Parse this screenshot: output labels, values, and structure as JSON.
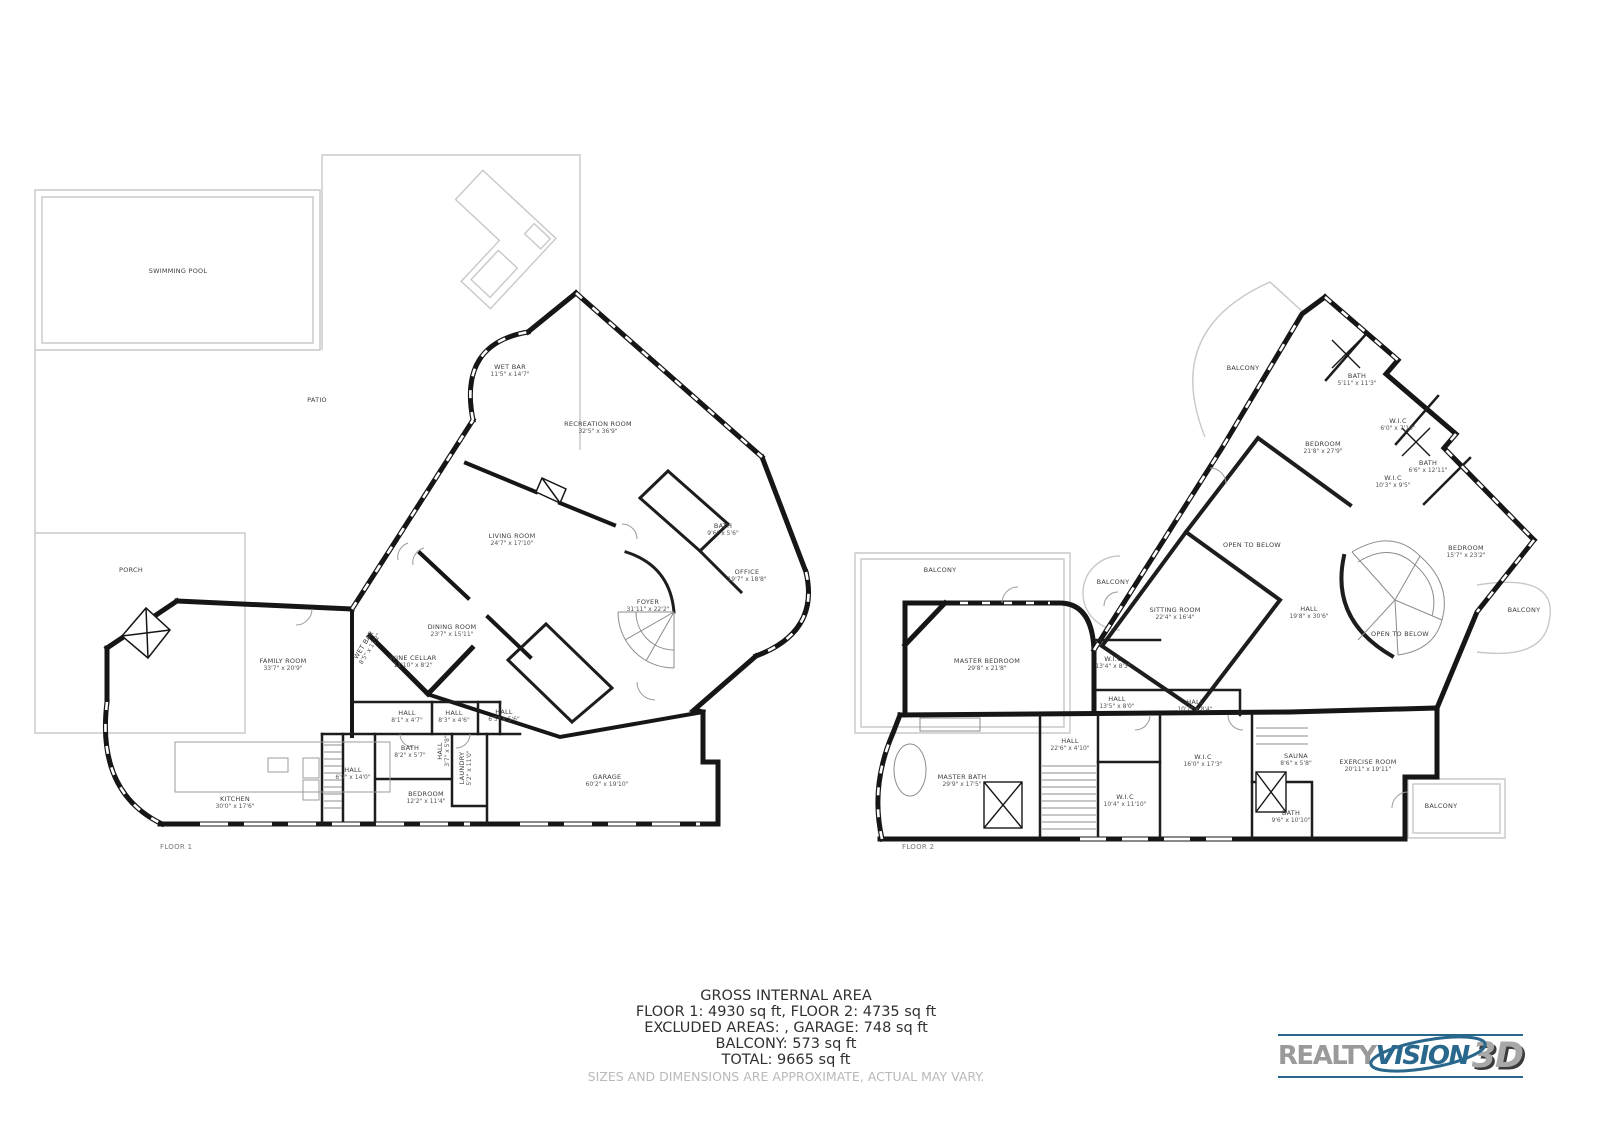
{
  "summary": {
    "title": "GROSS INTERNAL AREA",
    "lines": [
      "FLOOR 1: 4930 sq ft, FLOOR 2: 4735 sq ft",
      "EXCLUDED AREAS: , GARAGE: 748 sq ft",
      "BALCONY: 573 sq ft",
      "TOTAL: 9665 sq ft"
    ],
    "disclaimer": "SIZES AND DIMENSIONS ARE APPROXIMATE, ACTUAL MAY VARY."
  },
  "logo": {
    "part1": "REALTY",
    "part2": "VISION",
    "part3": "3D",
    "accent_color": "#29678c",
    "gray_color": "#9a9a9a"
  },
  "floors": [
    {
      "id": "floor1",
      "label": "FLOOR 1",
      "label_pos": {
        "x": 160,
        "y": 843
      },
      "rooms": [
        {
          "name": "SWIMMING POOL",
          "dims": "",
          "x": 178,
          "y": 271
        },
        {
          "name": "PATIO",
          "dims": "",
          "x": 317,
          "y": 400
        },
        {
          "name": "PORCH",
          "dims": "",
          "x": 131,
          "y": 570
        },
        {
          "name": "WET BAR",
          "dims": "11'5\" x 14'7\"",
          "x": 510,
          "y": 371
        },
        {
          "name": "RECREATION ROOM",
          "dims": "32'5\" x 36'9\"",
          "x": 598,
          "y": 428
        },
        {
          "name": "LIVING ROOM",
          "dims": "24'7\" x 17'10\"",
          "x": 512,
          "y": 540
        },
        {
          "name": "DINING ROOM",
          "dims": "23'7\" x 15'11\"",
          "x": 452,
          "y": 631
        },
        {
          "name": "FOYER",
          "dims": "31'11\" x 22'2\"",
          "x": 648,
          "y": 606
        },
        {
          "name": "OFFICE",
          "dims": "19'7\" x 18'8\"",
          "x": 747,
          "y": 576
        },
        {
          "name": "BATH",
          "dims": "9'6\" x 5'6\"",
          "x": 723,
          "y": 530
        },
        {
          "name": "WET BAR",
          "dims": "8'5\" x 11'2\"",
          "x": 367,
          "y": 647,
          "rot": -58
        },
        {
          "name": "WINE CELLAR",
          "dims": "11'10\" x 8'2\"",
          "x": 413,
          "y": 662
        },
        {
          "name": "FAMILY ROOM",
          "dims": "33'7\" x 20'9\"",
          "x": 283,
          "y": 665
        },
        {
          "name": "HALL",
          "dims": "8'1\" x 4'7\"",
          "x": 407,
          "y": 717
        },
        {
          "name": "HALL",
          "dims": "8'3\" x 4'6\"",
          "x": 454,
          "y": 717
        },
        {
          "name": "HALL",
          "dims": "6'5\" x 5'6\"",
          "x": 504,
          "y": 716
        },
        {
          "name": "BATH",
          "dims": "8'2\" x 5'7\"",
          "x": 410,
          "y": 752
        },
        {
          "name": "HALL",
          "dims": "3'7\" x 5'8\"",
          "x": 444,
          "y": 751,
          "rot": -90
        },
        {
          "name": "LAUNDRY",
          "dims": "5'2\" x 11'0\"",
          "x": 466,
          "y": 768,
          "rot": -90
        },
        {
          "name": "HALL",
          "dims": "6'9\" x 14'0\"",
          "x": 353,
          "y": 774
        },
        {
          "name": "BEDROOM",
          "dims": "12'2\" x 11'4\"",
          "x": 426,
          "y": 798
        },
        {
          "name": "KITCHEN",
          "dims": "30'0\" x 17'6\"",
          "x": 235,
          "y": 803
        },
        {
          "name": "GARAGE",
          "dims": "60'2\" x 19'10\"",
          "x": 607,
          "y": 781
        }
      ]
    },
    {
      "id": "floor2",
      "label": "FLOOR 2",
      "label_pos": {
        "x": 902,
        "y": 843
      },
      "rooms": [
        {
          "name": "BALCONY",
          "dims": "",
          "x": 1243,
          "y": 368
        },
        {
          "name": "BATH",
          "dims": "5'11\" x 11'3\"",
          "x": 1357,
          "y": 380
        },
        {
          "name": "W.I.C",
          "dims": "6'0\" x 7'10\"",
          "x": 1398,
          "y": 425
        },
        {
          "name": "BEDROOM",
          "dims": "21'8\" x 27'9\"",
          "x": 1323,
          "y": 448
        },
        {
          "name": "BATH",
          "dims": "6'6\" x 12'11\"",
          "x": 1428,
          "y": 467
        },
        {
          "name": "W.I.C",
          "dims": "10'3\" x 9'5\"",
          "x": 1393,
          "y": 482
        },
        {
          "name": "OPEN TO BELOW",
          "dims": "",
          "x": 1252,
          "y": 545
        },
        {
          "name": "BEDROOM",
          "dims": "15'7\" x 23'2\"",
          "x": 1466,
          "y": 552
        },
        {
          "name": "BALCONY",
          "dims": "",
          "x": 940,
          "y": 570
        },
        {
          "name": "BALCONY",
          "dims": "",
          "x": 1113,
          "y": 582
        },
        {
          "name": "SITTING ROOM",
          "dims": "22'4\" x 16'4\"",
          "x": 1175,
          "y": 614
        },
        {
          "name": "HALL",
          "dims": "19'8\" x 30'6\"",
          "x": 1309,
          "y": 613
        },
        {
          "name": "OPEN TO BELOW",
          "dims": "",
          "x": 1400,
          "y": 634
        },
        {
          "name": "BALCONY",
          "dims": "",
          "x": 1524,
          "y": 610
        },
        {
          "name": "MASTER BEDROOM",
          "dims": "29'8\" x 21'8\"",
          "x": 987,
          "y": 665
        },
        {
          "name": "W.I.C",
          "dims": "13'4\" x 8'3\"",
          "x": 1113,
          "y": 663
        },
        {
          "name": "HALL",
          "dims": "13'5\" x 8'0\"",
          "x": 1117,
          "y": 703
        },
        {
          "name": "HALL",
          "dims": "10'7\" x 8'4\"",
          "x": 1195,
          "y": 706
        },
        {
          "name": "HALL",
          "dims": "22'6\" x 4'10\"",
          "x": 1070,
          "y": 745
        },
        {
          "name": "MASTER BATH",
          "dims": "29'9\" x 17'5\"",
          "x": 962,
          "y": 781
        },
        {
          "name": "W.I.C",
          "dims": "16'0\" x 17'3\"",
          "x": 1203,
          "y": 761
        },
        {
          "name": "W.I.C",
          "dims": "10'4\" x 11'10\"",
          "x": 1125,
          "y": 801
        },
        {
          "name": "SAUNA",
          "dims": "8'6\" x 5'8\"",
          "x": 1296,
          "y": 760
        },
        {
          "name": "BATH",
          "dims": "9'6\" x 10'10\"",
          "x": 1291,
          "y": 817
        },
        {
          "name": "EXERCISE ROOM",
          "dims": "20'11\" x 19'11\"",
          "x": 1368,
          "y": 766
        },
        {
          "name": "BALCONY",
          "dims": "",
          "x": 1441,
          "y": 806
        }
      ]
    }
  ]
}
